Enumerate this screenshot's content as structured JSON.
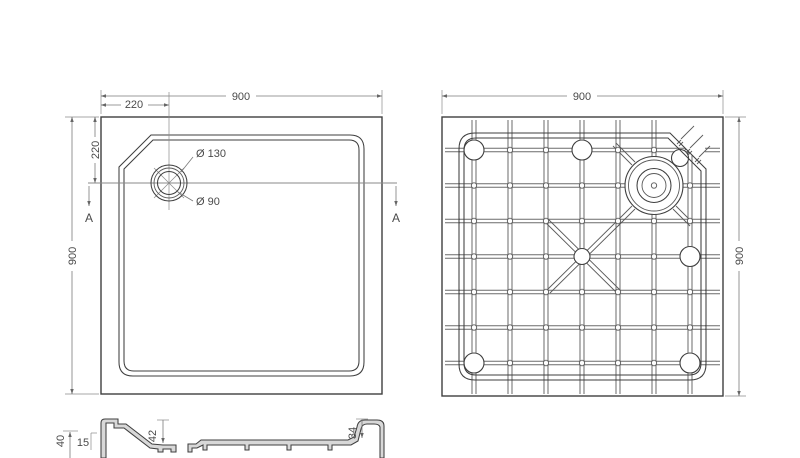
{
  "drawing": {
    "type": "square shower tray technical drawing",
    "views": [
      "top view",
      "bottom view",
      "section A-A"
    ]
  },
  "colors": {
    "background": "#ffffff",
    "line": "#3f3f3f",
    "rib_line": "#5a5a5a",
    "dimension_line": "#7a7a7a",
    "text": "#4a4a4a",
    "section_fill": "#d8d8d8"
  },
  "top_view": {
    "width_dim": "900",
    "height_dim": "900",
    "drain_offset_x_dim": "220",
    "drain_offset_y_dim": "220",
    "drain_outer_diameter": "Ø 130",
    "drain_inner_diameter": "Ø 90",
    "section_marker": "A"
  },
  "bottom_view": {
    "width_dim": "900",
    "height_dim": "900"
  },
  "section_view": {
    "total_height_dim": "40",
    "rim_height_dim": "15",
    "drain_recess_depth_dim": "42",
    "edge_height_dim": "34"
  }
}
